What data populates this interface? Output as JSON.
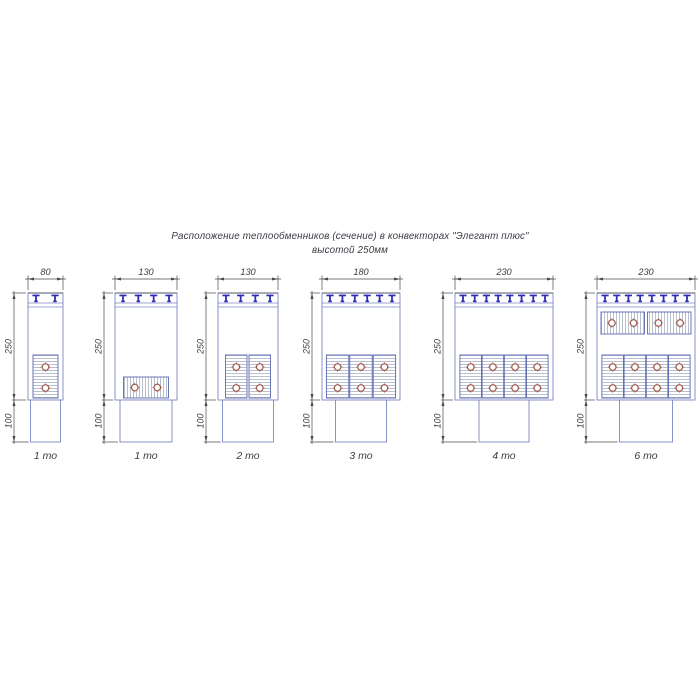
{
  "title": {
    "line1": "Расположение теплообменников (сечение) в конвекторах \"Элегант плюс\"",
    "line2": "высотой 250мм"
  },
  "drawing": {
    "body_height_label": "250",
    "plinth_height_label": "100",
    "convectors": [
      {
        "width_label": "80",
        "unit_label": "1 то",
        "tee_count": 2,
        "exchangers": [
          {
            "position": "bottom",
            "orientation": "vertical",
            "count": 1,
            "tubes_per_unit": 2
          }
        ]
      },
      {
        "width_label": "130",
        "unit_label": "1 то",
        "tee_count": 4,
        "exchangers": [
          {
            "position": "bottom",
            "orientation": "horizontal",
            "count": 1,
            "tubes_per_unit": 2
          }
        ]
      },
      {
        "width_label": "130",
        "unit_label": "2 то",
        "tee_count": 4,
        "exchangers": [
          {
            "position": "bottom",
            "orientation": "vertical",
            "count": 2,
            "tubes_per_unit": 2
          }
        ]
      },
      {
        "width_label": "180",
        "unit_label": "3 то",
        "tee_count": 6,
        "exchangers": [
          {
            "position": "bottom",
            "orientation": "vertical",
            "count": 3,
            "tubes_per_unit": 2
          }
        ]
      },
      {
        "width_label": "230",
        "unit_label": "4 то",
        "tee_count": 8,
        "exchangers": [
          {
            "position": "bottom",
            "orientation": "vertical",
            "count": 4,
            "tubes_per_unit": 2
          }
        ]
      },
      {
        "width_label": "230",
        "unit_label": "6 то",
        "tee_count": 8,
        "exchangers": [
          {
            "position": "top",
            "orientation": "horizontal",
            "count": 2,
            "tubes_per_unit": 2
          },
          {
            "position": "bottom",
            "orientation": "vertical",
            "count": 4,
            "tubes_per_unit": 2
          }
        ]
      }
    ]
  },
  "colors": {
    "background": "#ffffff",
    "body_line": "#7b87c6",
    "body_top_line": "#50506e",
    "tee_blue": "#2e2eb4",
    "exchanger_border": "#5c68b0",
    "hatch": "#9aa4bc",
    "tube_ring": "#a2584b",
    "tube_cross": "#8a4a42",
    "dim_line": "#4a4a4a",
    "text": "#3a3a44"
  }
}
